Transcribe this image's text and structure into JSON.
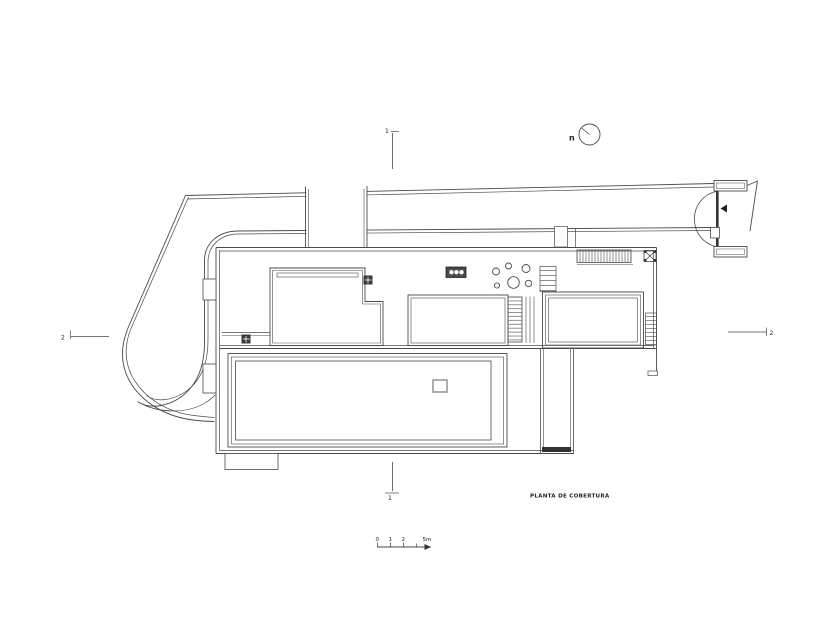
{
  "drawing": {
    "title": "PLANTA DE COBERTURA"
  },
  "north_indicator": {
    "label": "n"
  },
  "section_markers": {
    "top": "1",
    "bottom": "1",
    "left": "2",
    "right": "2"
  },
  "scale_bar": {
    "labels": [
      "0",
      "1",
      "2"
    ],
    "end_label": "5m"
  },
  "colors": {
    "line": "#4a4a4a",
    "dark": "#333333",
    "background": "#ffffff"
  }
}
